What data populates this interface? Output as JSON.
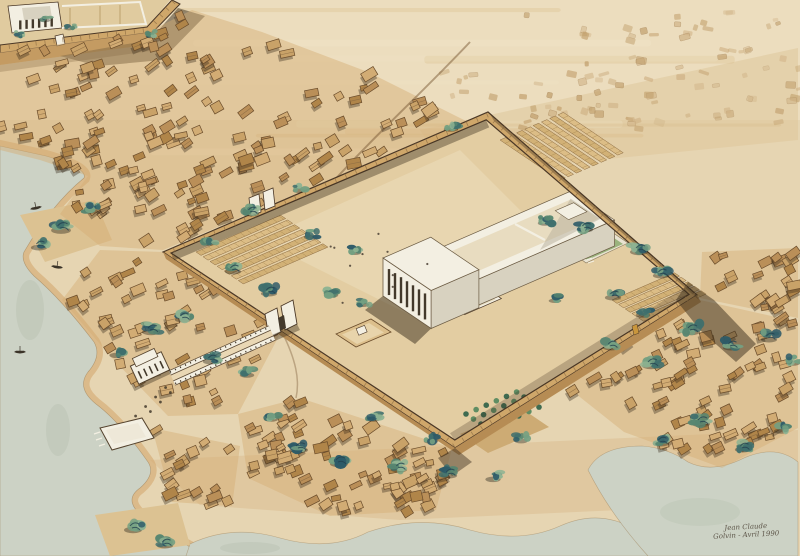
{
  "artwork": {
    "signature_line1": "Jean Claude",
    "signature_line2": "Golvin - Avril 1990"
  },
  "palette": {
    "paperSand": "#e6d5b2",
    "sandLight": "#f0e4c8",
    "sandWarm": "#dec69a",
    "shore": "#d3a96f",
    "water": "#ccd2c5",
    "waterDeep": "#b9c2b2",
    "ruin": "#c2a06d",
    "ruinDark": "#a8865a",
    "ground": "#e3cda2",
    "groundTown": "#d4ad74",
    "court": "#e0cb9f",
    "courtLight": "#eedfbd",
    "wallTop": "#cfa76a",
    "wallFace": "#b68c54",
    "wallLine": "#4a3726",
    "white": "#f3efe2",
    "whiteShade": "#d8d2c0",
    "slit": "#43392b",
    "lake": "#9ab37d",
    "lakeShade": "#7e9c66",
    "lakeRim": "#e9e3d1",
    "shadow": "#3a2d1c",
    "ink": "#4a4034",
    "road": "#7a5a36",
    "house1": "#c9a268",
    "house2": "#ba8f58",
    "house3": "#d2ac74",
    "house4": "#b08549",
    "houseStroke": "#6a4c2b",
    "green1": "#2d5a68",
    "green2": "#3f6f6d",
    "green3": "#568570",
    "green4": "#74a082",
    "green5": "#8fb392",
    "boat": "#3a3328",
    "goldDoor": "#c9963c",
    "storeA": "#dcbd86",
    "storeB": "#d2b176",
    "storeHatch": "#a08048",
    "shrine": "#dcbf8c",
    "shrineCourt": "#e8d4ab",
    "orchGround": "#cdab74"
  },
  "scene": {
    "house_regions": [
      {
        "name": "upper-town",
        "poly": [
          [
            0,
            52
          ],
          [
            148,
            32
          ],
          [
            192,
            10
          ],
          [
            262,
            32
          ],
          [
            368,
            72
          ],
          [
            468,
            122
          ],
          [
            163,
            250
          ],
          [
            100,
            246
          ],
          [
            60,
            214
          ],
          [
            88,
            176
          ],
          [
            40,
            160
          ],
          [
            0,
            150
          ]
        ],
        "count": 165,
        "seed": 11
      },
      {
        "name": "west-town",
        "poly": [
          [
            100,
            250
          ],
          [
            163,
            252
          ],
          [
            282,
            330
          ],
          [
            238,
            414
          ],
          [
            168,
            416
          ],
          [
            112,
            358
          ],
          [
            62,
            300
          ]
        ],
        "count": 55,
        "seed": 22
      },
      {
        "name": "south-town",
        "poly": [
          [
            238,
            414
          ],
          [
            300,
            398
          ],
          [
            452,
            448
          ],
          [
            436,
            510
          ],
          [
            330,
            516
          ],
          [
            248,
            478
          ]
        ],
        "count": 72,
        "seed": 33
      },
      {
        "name": "east-town",
        "poly": [
          [
            560,
            336
          ],
          [
            700,
            300
          ],
          [
            798,
            322
          ],
          [
            798,
            428
          ],
          [
            722,
            468
          ],
          [
            624,
            432
          ],
          [
            566,
            386
          ]
        ],
        "count": 85,
        "seed": 44
      },
      {
        "name": "far-east-town",
        "poly": [
          [
            702,
            252
          ],
          [
            798,
            248
          ],
          [
            798,
            318
          ],
          [
            700,
            298
          ]
        ],
        "count": 22,
        "seed": 55
      },
      {
        "name": "quay-town",
        "poly": [
          [
            152,
            428
          ],
          [
            240,
            446
          ],
          [
            232,
            506
          ],
          [
            172,
            502
          ]
        ],
        "count": 16,
        "seed": 66
      }
    ],
    "tree_clusters": [
      [
        62,
        226,
        1.1
      ],
      [
        40,
        244,
        0.9
      ],
      [
        92,
        208,
        0.8
      ],
      [
        134,
        526,
        1.0
      ],
      [
        166,
        542,
        0.9
      ],
      [
        252,
        210,
        0.9
      ],
      [
        312,
        234,
        0.8
      ],
      [
        356,
        250,
        0.7
      ],
      [
        452,
        126,
        0.8
      ],
      [
        210,
        240,
        0.8
      ],
      [
        300,
        188,
        0.7
      ],
      [
        46,
        18,
        0.6
      ],
      [
        70,
        26,
        0.6
      ],
      [
        20,
        34,
        0.5
      ],
      [
        152,
        34,
        0.6
      ],
      [
        152,
        328,
        1.0
      ],
      [
        184,
        316,
        0.9
      ],
      [
        118,
        352,
        0.85
      ],
      [
        212,
        358,
        0.9
      ],
      [
        248,
        372,
        0.8
      ],
      [
        234,
        268,
        0.9
      ],
      [
        270,
        290,
        0.9
      ],
      [
        332,
        292,
        0.8
      ],
      [
        364,
        302,
        0.7
      ],
      [
        546,
        220,
        0.8
      ],
      [
        586,
        226,
        0.9
      ],
      [
        640,
        248,
        1.0
      ],
      [
        662,
        272,
        0.9
      ],
      [
        614,
        294,
        0.9
      ],
      [
        644,
        312,
        0.8
      ],
      [
        556,
        298,
        0.7
      ],
      [
        692,
        328,
        1.0
      ],
      [
        732,
        344,
        0.9
      ],
      [
        770,
        336,
        0.9
      ],
      [
        794,
        360,
        0.8
      ],
      [
        612,
        344,
        0.9
      ],
      [
        652,
        362,
        1.0
      ],
      [
        702,
        420,
        1.0
      ],
      [
        744,
        446,
        0.9
      ],
      [
        662,
        440,
        0.9
      ],
      [
        782,
        428,
        0.8
      ],
      [
        300,
        446,
        1.0
      ],
      [
        340,
        460,
        1.0
      ],
      [
        400,
        466,
        0.9
      ],
      [
        450,
        472,
        0.9
      ],
      [
        494,
        476,
        0.85
      ],
      [
        272,
        416,
        0.8
      ],
      [
        374,
        416,
        0.8
      ],
      [
        432,
        438,
        0.8
      ],
      [
        522,
        438,
        0.75
      ]
    ],
    "ruin_fields": [
      {
        "poly": [
          [
            435,
            70
          ],
          [
            798,
            40
          ],
          [
            798,
            122
          ],
          [
            455,
            132
          ]
        ],
        "count": 75,
        "seed": 3
      },
      {
        "poly": [
          [
            500,
            12
          ],
          [
            795,
            8
          ],
          [
            795,
            36
          ],
          [
            520,
            40
          ]
        ],
        "count": 22,
        "seed": 4
      }
    ],
    "figure_groups": [
      {
        "poly": [
          [
            302,
            256
          ],
          [
            420,
            208
          ],
          [
            466,
            252
          ],
          [
            332,
            316
          ]
        ],
        "count": 10,
        "seed": 7
      },
      {
        "poly": [
          [
            150,
            380
          ],
          [
            260,
            330
          ],
          [
            270,
            342
          ],
          [
            158,
            395
          ]
        ],
        "count": 6,
        "seed": 8
      }
    ],
    "storehouses": [
      {
        "origin": [
          196,
          252
        ],
        "axis": "u",
        "len": 92,
        "count": 7,
        "spacing": 8.5
      },
      {
        "origin": [
          500,
          140
        ],
        "axis": "v",
        "len": 72,
        "count": 8,
        "spacing": 9
      },
      {
        "origin": [
          612,
          300
        ],
        "axis": "u",
        "len": 68,
        "count": 5,
        "spacing": 8
      }
    ],
    "colonnade": {
      "from": [
        272,
        333
      ],
      "to": [
        172,
        378
      ]
    },
    "sphinx_path": {
      "from": [
        168,
        390
      ],
      "to": [
        128,
        428
      ],
      "pairs": 5
    },
    "orchard": {
      "origin": [
        466,
        414
      ],
      "cols": 6,
      "rows": 4,
      "du": 11,
      "dv": 9
    },
    "facade_slits": {
      "a": [
        383,
        296
      ],
      "b": [
        431,
        328.5
      ],
      "n": 7,
      "h": 26,
      "lift": 5
    },
    "mini_facade_slits": {
      "a": [
        14,
        31
      ],
      "b": [
        58,
        27
      ],
      "n": 6,
      "h": 9,
      "lift": 1
    },
    "wall_ticks_main": [
      [
        163,
        252
      ],
      [
        488,
        112
      ],
      [
        697,
        295
      ],
      [
        455,
        448
      ],
      [
        163,
        252
      ]
    ],
    "wall_ticks_upper": [
      [
        0,
        45
      ],
      [
        147,
        27
      ],
      [
        172,
        0
      ]
    ],
    "boats": [
      [
        36,
        208,
        -12
      ],
      [
        57,
        267,
        8
      ],
      [
        20,
        352,
        0
      ]
    ],
    "streaks": {
      "count": 10,
      "seed": 5
    }
  }
}
